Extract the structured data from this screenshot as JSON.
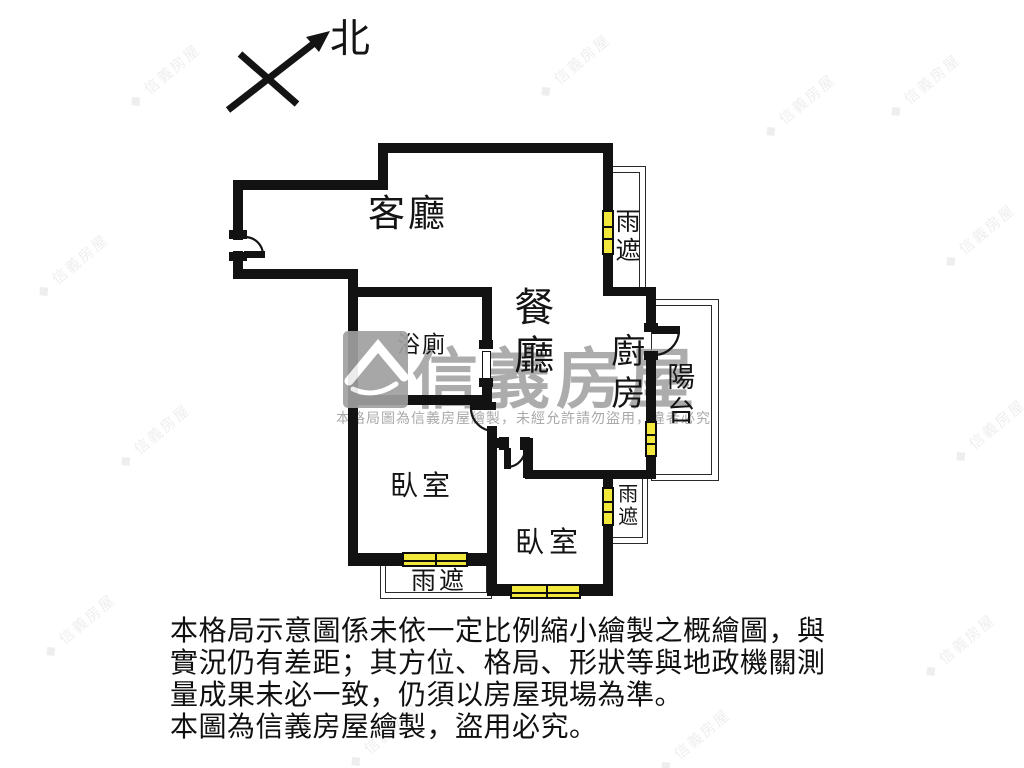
{
  "compass": {
    "north_label": "北"
  },
  "rooms": {
    "living": "客廳",
    "dining": "餐廳",
    "bathroom": "浴廁",
    "kitchen": "廚房",
    "balcony": "陽台",
    "bedroom_left": "臥室",
    "bedroom_right": "臥室"
  },
  "canopies": {
    "top_right": "雨遮",
    "bottom_left": "雨遮",
    "right": "雨遮"
  },
  "watermark": {
    "brand": "信義房屋",
    "notice": "本格局圖為信義房屋繪製，未經允許請勿盜用，違者必究"
  },
  "disclaimer_lines": [
    "本格局示意圖係未依一定比例縮小繪製之概繪圖，與",
    "實況仍有差距；其方位、格局、形狀等與地政機關測",
    "量成果未必一致，仍須以房屋現場為準。",
    "本圖為信義房屋繪製，盜用必究。"
  ],
  "colors": {
    "wall": "#121212",
    "window_fill": "#f2e83b",
    "watermark_gray": "#9e9e9e",
    "canopy_line": "#2a2a2a"
  }
}
